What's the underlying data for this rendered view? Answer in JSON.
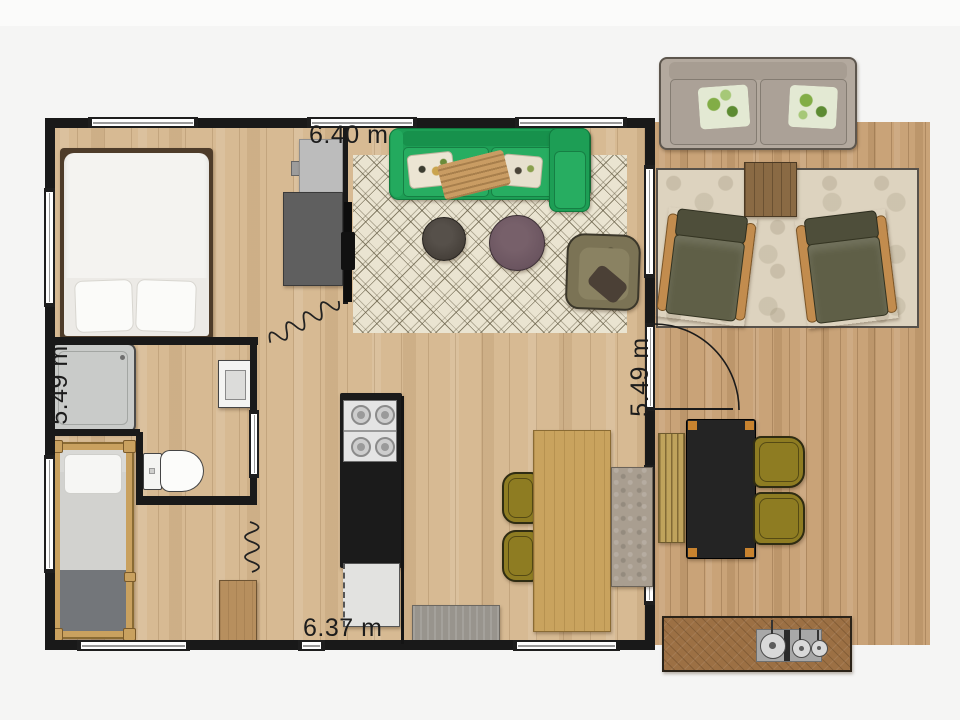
{
  "dimensions": {
    "top": "6.40 m",
    "left": "5.49 m",
    "right": "5.49 m",
    "bottom": "6.37 m"
  },
  "colors": {
    "background": "#f5f5f4",
    "wall": "#191919",
    "interior_wood": "#d7ba93",
    "deck_wood": "#c9a378",
    "sofa_green": "#1d9e55",
    "living_rug": "#eae4d1",
    "deck_rug": "#ddd3bf",
    "dining_wood": "#c9a35e",
    "olive_chair": "#8e7c22",
    "outdoor_table": "#242424",
    "armchair_cushion": "#5f5f47"
  },
  "rooms": [
    "bedroom",
    "bathroom",
    "single-bedroom",
    "living-room",
    "kitchen",
    "dining-area",
    "deck"
  ],
  "furniture": [
    "double-bed",
    "dresser",
    "media-desk",
    "tv",
    "green-sofa",
    "round-coffee-tables",
    "patterned-armchair",
    "living-rug",
    "kitchen-counter-stove",
    "fridge",
    "doormat",
    "dining-table",
    "dining-chairs",
    "dining-bench",
    "shower",
    "toilet",
    "vanity",
    "single-bed",
    "wardrobe",
    "outdoor-sofa",
    "outdoor-rug",
    "outdoor-coffee-table",
    "outdoor-armchairs",
    "outdoor-dining-table",
    "outdoor-bench",
    "outdoor-chairs",
    "outdoor-kitchen-island"
  ]
}
